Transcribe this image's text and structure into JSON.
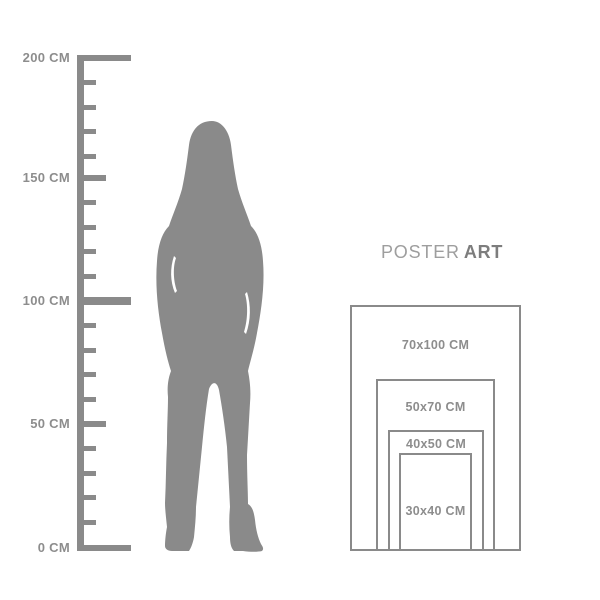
{
  "title": {
    "brand": "POSTER",
    "brand_bold": "ART"
  },
  "ruler": {
    "labels": [
      "200 CM",
      "150 CM",
      "100 CM",
      "50 CM",
      "0 CM"
    ]
  },
  "size_chart": {
    "sizes": [
      {
        "label": "70x100 CM"
      },
      {
        "label": "50x70 CM"
      },
      {
        "label": "40x50 CM"
      },
      {
        "label": "30x40 CM"
      }
    ]
  },
  "colors": {
    "shape_gray": "#8a8a8a",
    "label_gray": "#8d8d8d",
    "title_light_gray": "#9e9e9e",
    "title_dark_gray": "#7d7d7d",
    "background": "#ffffff"
  }
}
